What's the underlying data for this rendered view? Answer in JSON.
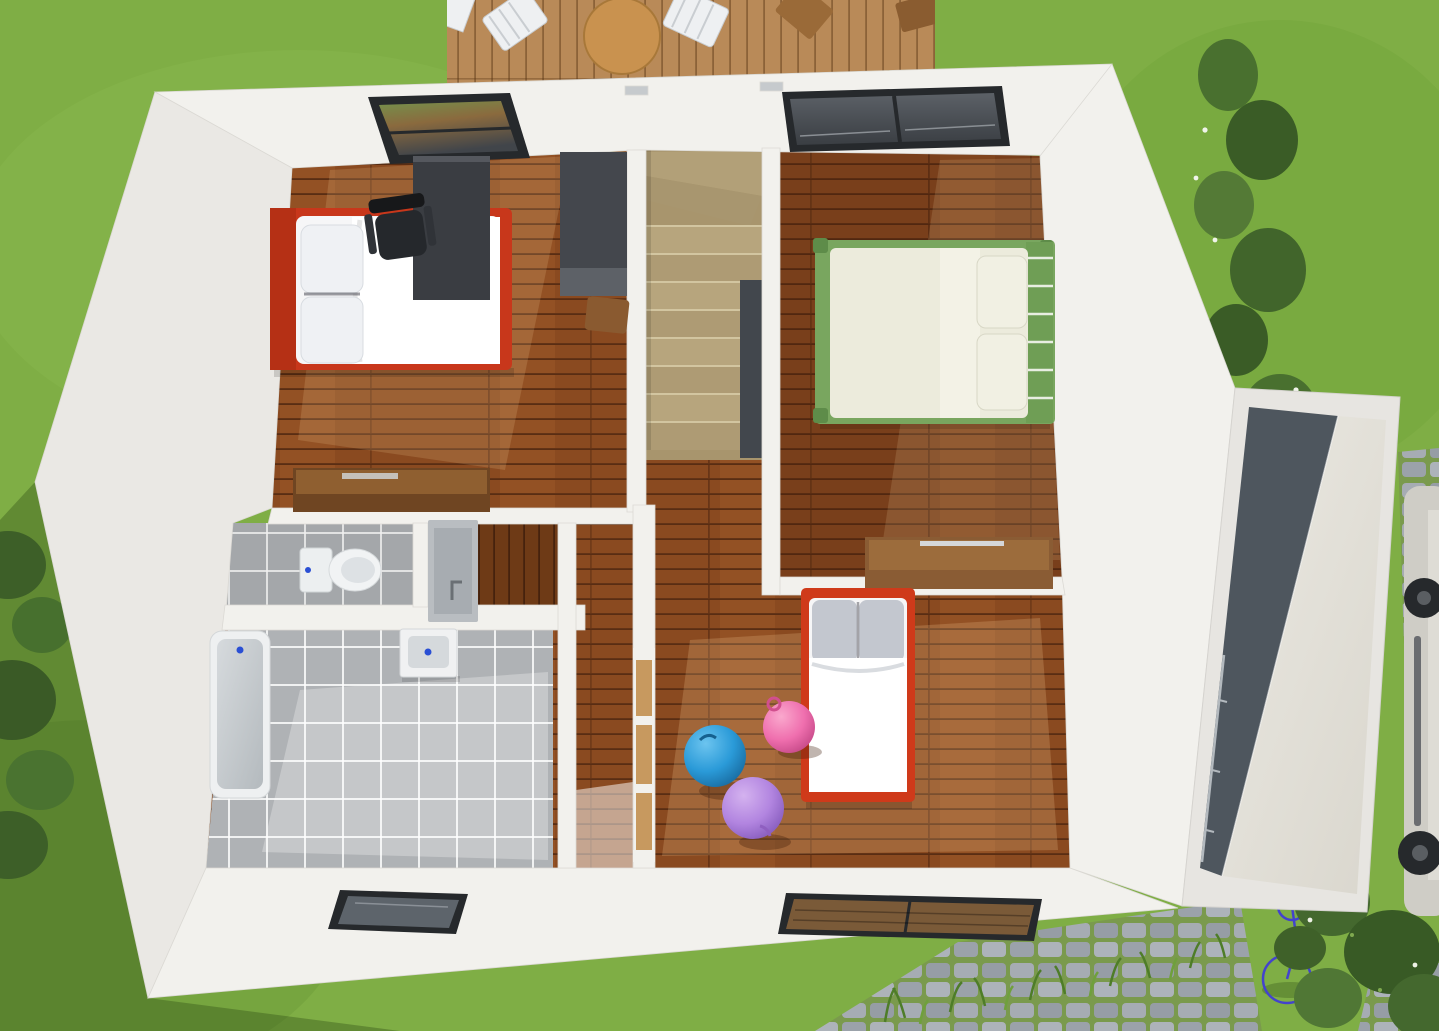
{
  "scene": {
    "kind": "3d-floorplan-render",
    "view": "top-down-cutaway",
    "level": "upper-floor"
  },
  "palette": {
    "grass": "#7fae45",
    "wall": "#f2f1ed",
    "wallFace": "#eae8e4",
    "masterBed": "#c8371b",
    "kidsBed": "#cf3a1a",
    "greenBed": "#79a65f",
    "mattress": "#f6f6f7",
    "duvetCream": "#ecebdc",
    "pillowGray": "#c3c7cf",
    "desk": "#3a3d42",
    "wardrobe": "#44474d",
    "dresser": "#8a5c34",
    "dresserDark": "#6f4522",
    "doorTan": "#c7995f",
    "ballBlue": "#2a9ad8",
    "ballPink": "#ef6fae",
    "ballPurple": "#b285e0",
    "stairVoid": "#42474d",
    "garageDark": "#4e565e",
    "car": "#cfcdc6",
    "bike": "#4343cd",
    "toiletWhite": "#f1f3f4",
    "tubWhite": "#eef0f1",
    "windowFrame": "#26292c"
  },
  "rooms": [
    {
      "id": "master-bedroom",
      "floor": "hardwood",
      "furniture": [
        "double-bed-red",
        "pillows",
        "desk",
        "office-chair",
        "wardrobe",
        "dresser"
      ],
      "window": "top-wall-skylight"
    },
    {
      "id": "bedroom-green",
      "floor": "hardwood",
      "furniture": [
        "double-bed-green",
        "pillows",
        "dresser"
      ],
      "window": "top-wall-skylight"
    },
    {
      "id": "kids-bedroom",
      "floor": "hardwood",
      "furniture": [
        "single-bed-red",
        "gray-pillows",
        "play-balls"
      ],
      "window": "bottom-wall-window"
    },
    {
      "id": "bathroom",
      "floor": "gray-tile",
      "furniture": [
        "bathtub",
        "washbasin"
      ],
      "window": "bottom-wall-window"
    },
    {
      "id": "wc",
      "floor": "gray-tile",
      "furniture": [
        "toilet"
      ]
    },
    {
      "id": "washing-nook",
      "floor": "hardwood",
      "furniture": [
        "faucet-unit"
      ]
    },
    {
      "id": "hallway-landing",
      "floor": "hardwood",
      "furniture": [
        "tan-door"
      ]
    },
    {
      "id": "staircase",
      "floor": "winder-stairs",
      "furniture": []
    },
    {
      "id": "garage-annex",
      "floor": "concrete",
      "furniture": [
        "balcony-railing",
        "sloped-roof"
      ]
    }
  ],
  "play_balls": [
    {
      "color_name": "blue"
    },
    {
      "color_name": "pink"
    },
    {
      "color_name": "purple"
    }
  ],
  "outdoor": {
    "elements": [
      "lawn",
      "wooden-deck",
      "white-deck-chairs",
      "round-table",
      "wooden-chairs",
      "hedge-tree",
      "left-foliage",
      "shrubs",
      "cobblestone-paths",
      "tall-grass",
      "bicycle",
      "parked-car",
      "house-shadow"
    ]
  }
}
